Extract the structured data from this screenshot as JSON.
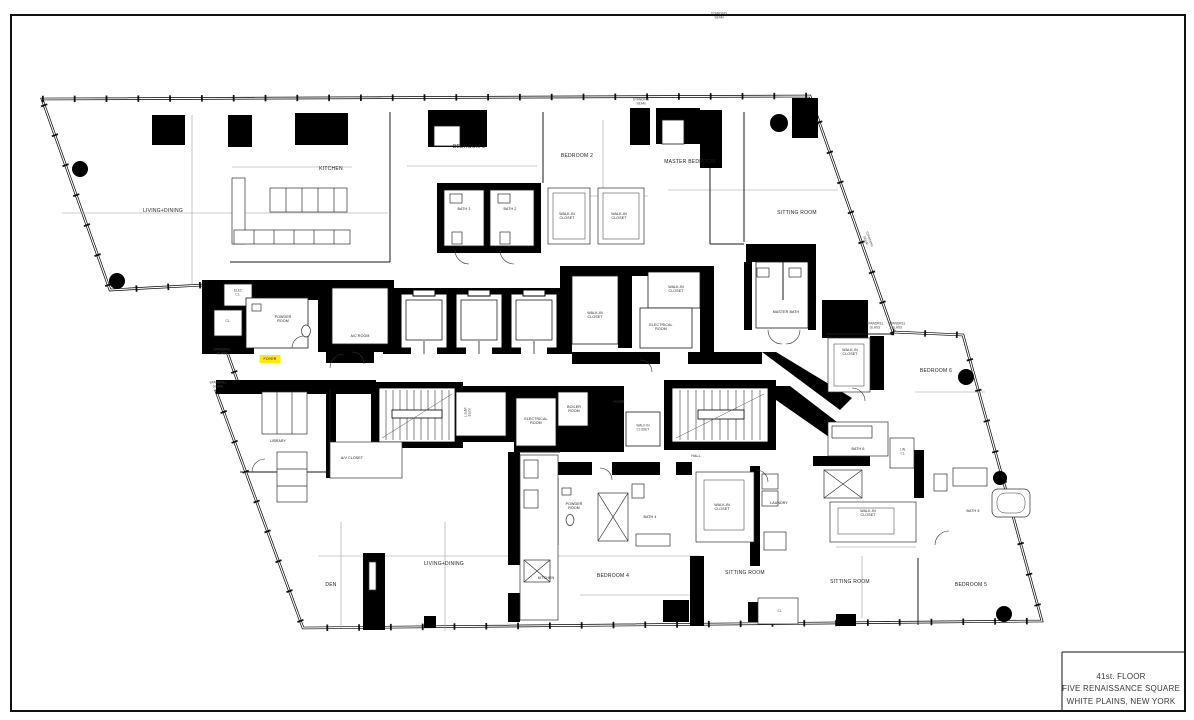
{
  "sheet": {
    "border_color": "#000000",
    "background": "#ffffff",
    "highlight_color": "#ffec00"
  },
  "title_block": {
    "lines": [
      "41st. FLOOR",
      "FIVE RENAISSANCE SQUARE",
      "WHITE PLAINS, NEW YORK"
    ]
  },
  "plan": {
    "labels": [
      {
        "text": "LIVING+DINING",
        "x": 163,
        "y": 212
      },
      {
        "text": "KITCHEN",
        "x": 331,
        "y": 170
      },
      {
        "text": "BEDROOM 3",
        "x": 469,
        "y": 148
      },
      {
        "text": "BATH 3",
        "x": 464,
        "y": 209,
        "cls": "small"
      },
      {
        "text": "BATH 2",
        "x": 510,
        "y": 209,
        "cls": "small"
      },
      {
        "text": "BEDROOM 2",
        "x": 577,
        "y": 157
      },
      {
        "text": "WALK-IN\nCLOSET",
        "x": 567,
        "y": 216,
        "cls": "small"
      },
      {
        "text": "WALK-IN\nCLOSET",
        "x": 619,
        "y": 216,
        "cls": "small"
      },
      {
        "text": "MASTER BEDROOM",
        "x": 690,
        "y": 163
      },
      {
        "text": "SITTING ROOM",
        "x": 797,
        "y": 214
      },
      {
        "text": "MASTER BATH",
        "x": 786,
        "y": 312,
        "cls": "small"
      },
      {
        "text": "WALK-IN\nCLOSET",
        "x": 595,
        "y": 315,
        "cls": "small"
      },
      {
        "text": "WALK-IN\nCLOSET",
        "x": 676,
        "y": 289,
        "cls": "small"
      },
      {
        "text": "ELECTRICAL\nROOM",
        "x": 661,
        "y": 327,
        "cls": "small"
      },
      {
        "text": "ELEC\nCL.",
        "x": 238,
        "y": 293,
        "cls": "tiny"
      },
      {
        "text": "CL.",
        "x": 228,
        "y": 322,
        "cls": "tiny"
      },
      {
        "text": "POWDER\nROOM",
        "x": 283,
        "y": 319,
        "cls": "small"
      },
      {
        "text": "A/C ROOM",
        "x": 360,
        "y": 336,
        "cls": "small"
      },
      {
        "text": "FOYER",
        "x": 270,
        "y": 359,
        "highlight": true,
        "cls": "small",
        "name": "highlighted-foyer-label"
      },
      {
        "text": "WALK-IN\nCLOSET",
        "x": 850,
        "y": 352,
        "cls": "small"
      },
      {
        "text": "BEDROOM 6",
        "x": 936,
        "y": 372
      },
      {
        "text": "L.S.&F.\nELEV.",
        "x": 468,
        "y": 412,
        "rot": -90,
        "cls": "tiny"
      },
      {
        "text": "ELECTRICAL\nROOM",
        "x": 536,
        "y": 421,
        "cls": "small"
      },
      {
        "text": "BOILER\nROOM",
        "x": 574,
        "y": 409,
        "cls": "small"
      },
      {
        "text": "FOYER",
        "x": 619,
        "y": 403,
        "cls": "tiny"
      },
      {
        "text": "WALK-IN\nCLOSET",
        "x": 643,
        "y": 428,
        "cls": "tiny"
      },
      {
        "text": "HALL",
        "x": 696,
        "y": 456,
        "cls": "small"
      },
      {
        "text": "LIBRARY",
        "x": 278,
        "y": 441,
        "cls": "small"
      },
      {
        "text": "A/V CLOSET",
        "x": 352,
        "y": 458,
        "cls": "small"
      },
      {
        "text": "DEN",
        "x": 331,
        "y": 586
      },
      {
        "text": "LIVING+DINING",
        "x": 444,
        "y": 565
      },
      {
        "text": "KITCHEN",
        "x": 546,
        "y": 578,
        "cls": "small"
      },
      {
        "text": "POWDER\nROOM",
        "x": 574,
        "y": 506,
        "cls": "small"
      },
      {
        "text": "BATH 4",
        "x": 650,
        "y": 517,
        "cls": "small"
      },
      {
        "text": "WALK-IN\nCLOSET",
        "x": 722,
        "y": 507,
        "cls": "small"
      },
      {
        "text": "LAUNDRY",
        "x": 779,
        "y": 503,
        "cls": "small"
      },
      {
        "text": "BEDROOM 4",
        "x": 613,
        "y": 577
      },
      {
        "text": "SITTING ROOM",
        "x": 745,
        "y": 574
      },
      {
        "text": "CL.",
        "x": 780,
        "y": 612,
        "cls": "tiny"
      },
      {
        "text": "BATH 6",
        "x": 858,
        "y": 449,
        "cls": "small"
      },
      {
        "text": "LIN.\nCL.",
        "x": 903,
        "y": 452,
        "cls": "tiny"
      },
      {
        "text": "WALK-IN\nCLOSET",
        "x": 868,
        "y": 513,
        "cls": "small"
      },
      {
        "text": "BATH 5",
        "x": 973,
        "y": 511,
        "cls": "small"
      },
      {
        "text": "SITTING ROOM",
        "x": 850,
        "y": 583
      },
      {
        "text": "BEDROOM 5",
        "x": 971,
        "y": 586
      },
      {
        "text": "SPANDREL\nGLASS",
        "x": 222,
        "y": 352,
        "cls": "tiny"
      },
      {
        "text": "SPANDREL\nGLASS",
        "x": 218,
        "y": 385,
        "cls": "tiny"
      },
      {
        "text": "SPANDREL\nGLASS",
        "x": 875,
        "y": 326,
        "cls": "tiny"
      },
      {
        "text": "SPANDREL\nGLASS",
        "x": 897,
        "y": 326,
        "cls": "tiny"
      },
      {
        "text": "STANDING\nSEAM",
        "x": 719,
        "y": 16,
        "cls": "tiny"
      },
      {
        "text": "STANDING\nSEAM",
        "x": 641,
        "y": 102,
        "cls": "tiny"
      },
      {
        "text": "STANDING\nSEAM",
        "x": 867,
        "y": 240,
        "rot": 70,
        "cls": "tiny"
      }
    ]
  }
}
